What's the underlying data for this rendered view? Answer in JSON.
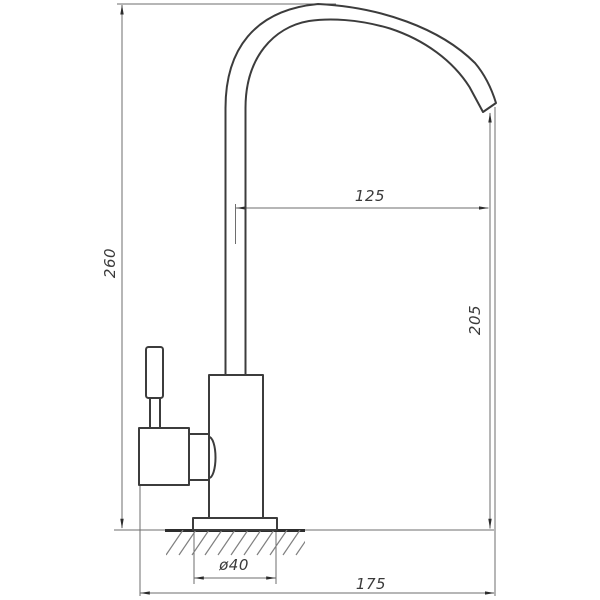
{
  "dimensions": {
    "total_height": {
      "label": "260"
    },
    "spout_reach": {
      "label": "125"
    },
    "outlet_height": {
      "label": "205"
    },
    "base_diameter": {
      "label": "ø40"
    },
    "total_depth": {
      "label": "175"
    }
  },
  "colors": {
    "background": "#ffffff",
    "object_line": "#3c3c3c",
    "dimension_line": "#6e6e6e",
    "text": "#3a3a3a"
  }
}
